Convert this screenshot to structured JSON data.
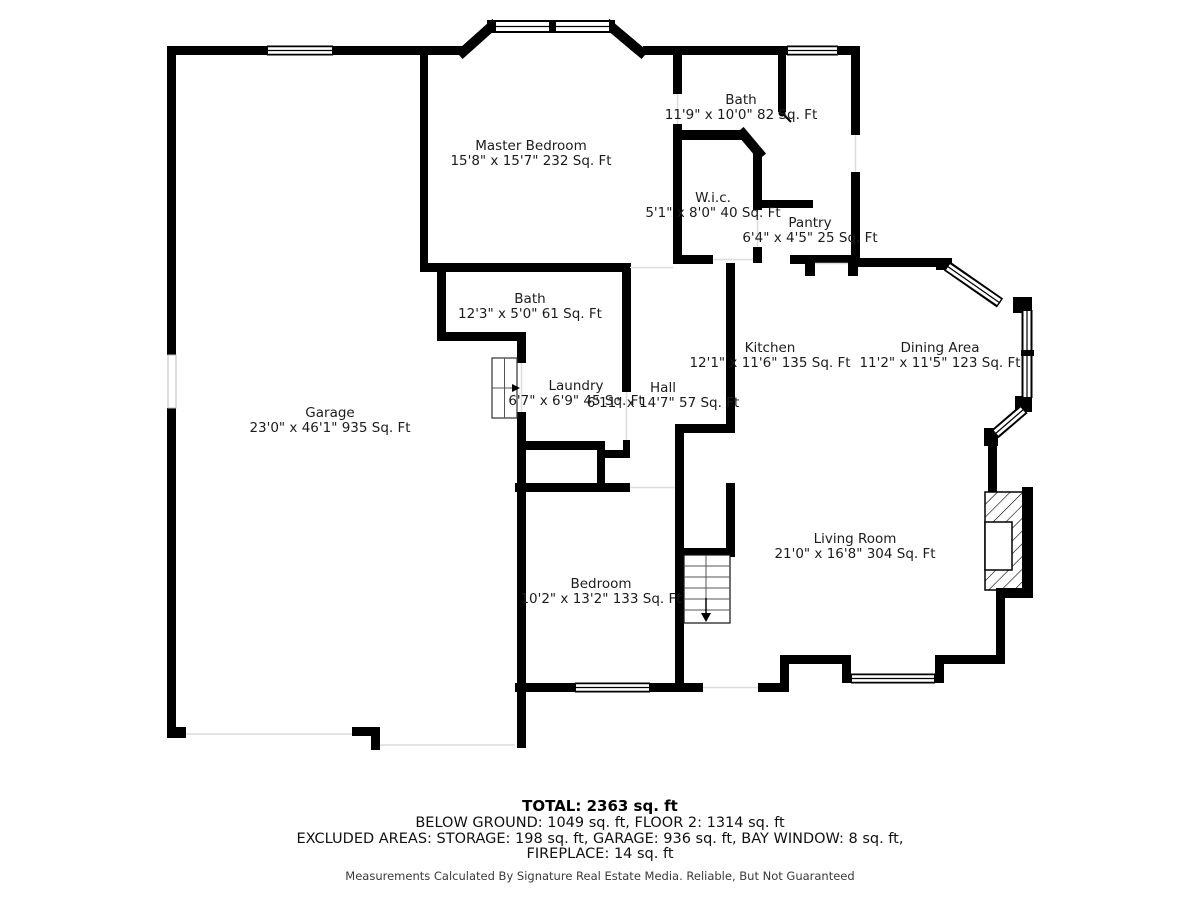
{
  "colors": {
    "wall": "#000000",
    "opening_line": "#dddddd",
    "text": "#1c1c1c",
    "background": "#ffffff",
    "frame_border": "#c9c9c9"
  },
  "rooms": [
    {
      "id": "master-bedroom",
      "name": "Master Bedroom",
      "dims": "15'8\" x 15'7\" 232 Sq. Ft"
    },
    {
      "id": "bath-upper",
      "name": "Bath",
      "dims": "11'9\" x 10'0\" 82 Sq. Ft"
    },
    {
      "id": "wic",
      "name": "W.i.c.",
      "dims": "5'1\" x 8'0\" 40 Sq. Ft"
    },
    {
      "id": "pantry",
      "name": "Pantry",
      "dims": "6'4\" x 4'5\" 25 Sq. Ft"
    },
    {
      "id": "bath-main",
      "name": "Bath",
      "dims": "12'3\" x 5'0\" 61 Sq. Ft"
    },
    {
      "id": "kitchen",
      "name": "Kitchen",
      "dims": "12'1\" x 11'6\" 135 Sq. Ft"
    },
    {
      "id": "dining-area",
      "name": "Dining Area",
      "dims": "11'2\" x 11'5\" 123 Sq. Ft"
    },
    {
      "id": "laundry",
      "name": "Laundry",
      "dims": "6'7\" x 6'9\" 45 Sq. Ft"
    },
    {
      "id": "hall",
      "name": "Hall",
      "dims": "6'11\" x 14'7\" 57 Sq. Ft"
    },
    {
      "id": "garage",
      "name": "Garage",
      "dims": "23'0\" x 46'1\" 935 Sq. Ft"
    },
    {
      "id": "living-room",
      "name": "Living Room",
      "dims": "21'0\" x 16'8\" 304 Sq. Ft"
    },
    {
      "id": "bedroom",
      "name": "Bedroom",
      "dims": "10'2\" x 13'2\" 133 Sq. Ft"
    }
  ],
  "summary": {
    "total": "TOTAL: 2363 sq. ft",
    "line2": "BELOW GROUND: 1049 sq. ft, FLOOR 2: 1314 sq. ft",
    "line3": "EXCLUDED AREAS: STORAGE: 198 sq. ft, GARAGE: 936 sq. ft, BAY WINDOW: 8 sq. ft,",
    "line4": "FIREPLACE: 14 sq. ft",
    "disclaimer": "Measurements Calculated By Signature Real Estate Media. Reliable, But Not Guaranteed"
  }
}
